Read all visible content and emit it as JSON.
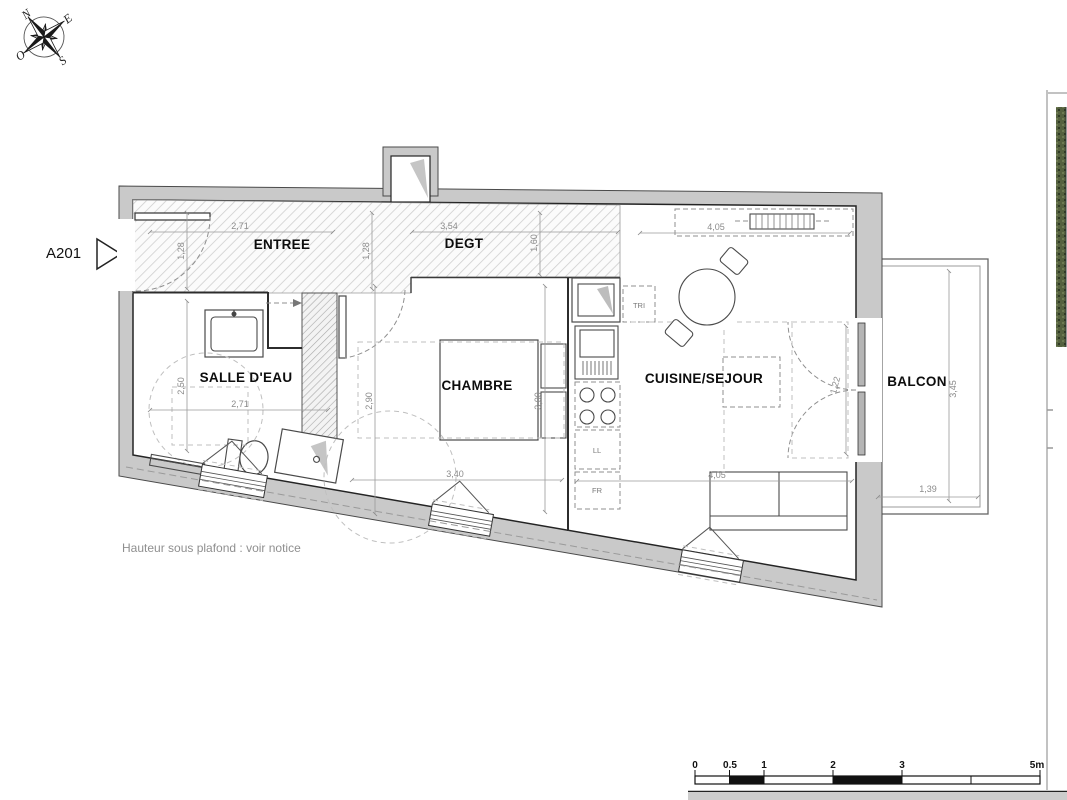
{
  "plan": {
    "marker": "A201",
    "note": "Hauteur sous plafond : voir notice",
    "compass": {
      "n": "N",
      "e": "E",
      "s": "S",
      "o": "O"
    },
    "rooms": {
      "entree": "ENTREE",
      "degt": "DEGT",
      "sde": "SALLE D'EAU",
      "chambre": "CHAMBRE",
      "cuisine": "CUISINE/SEJOUR",
      "balcon": "BALCON"
    },
    "appliances": {
      "tri": "TRI",
      "ll": "LL",
      "fr": "FR"
    },
    "dims": {
      "entree_w": "2,71",
      "entree_d1": "1,28",
      "entree_d2": "1,28",
      "degt_w": "3,54",
      "degt_d": "1,60",
      "sde_d": "2,50",
      "sde_w": "2,71",
      "chambre_d": "2,90",
      "chambre_d2": "3,00",
      "chambre_w": "3,40",
      "sejour_w_top": "4,05",
      "sejour_w": "4,05",
      "balcon_door": "1,22",
      "balcon_d": "3,45",
      "balcon_w": "1,39"
    },
    "scalebar": {
      "labels": [
        "0",
        "0.5",
        "1",
        "2",
        "3",
        "5m"
      ]
    },
    "colors": {
      "wall": "#c9c9c9",
      "line": "#2c2c2c",
      "dim": "#8b8b8b"
    }
  }
}
